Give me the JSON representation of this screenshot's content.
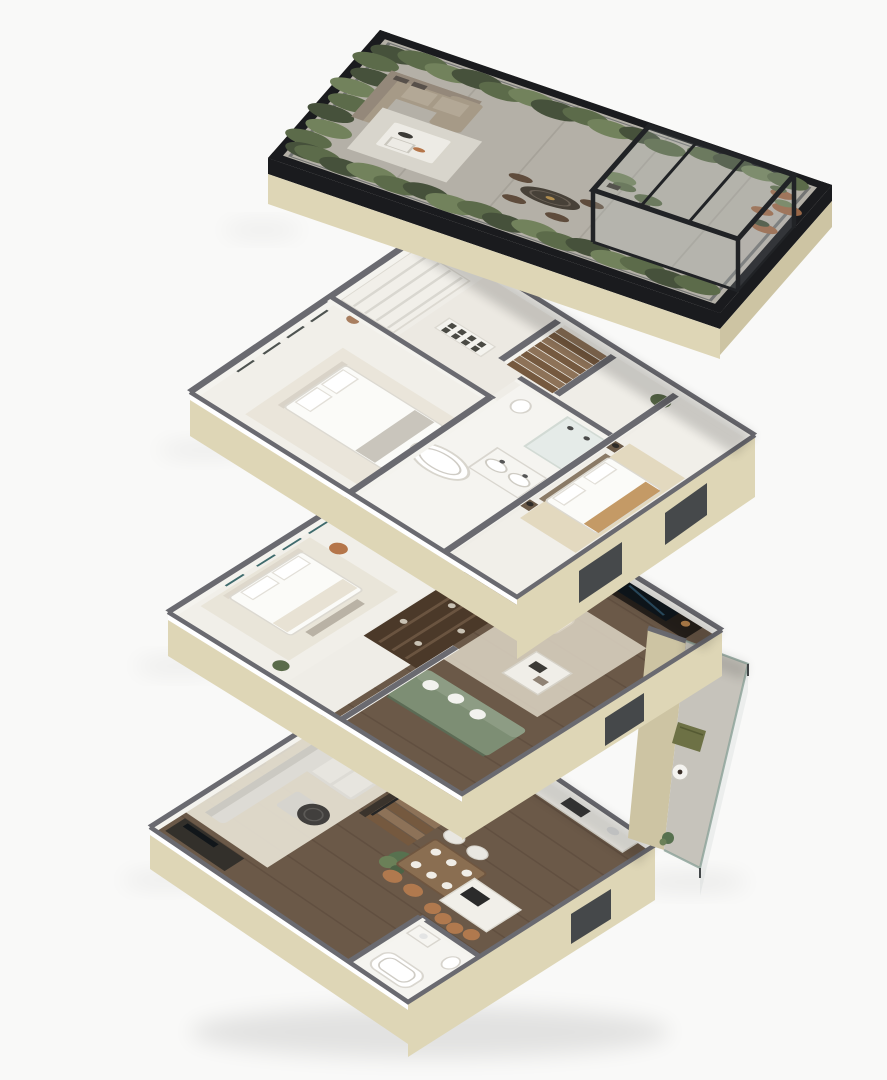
{
  "scene": {
    "type": "exploded-axonometric-floor-plan",
    "levels_count": 4,
    "floors": [
      {
        "id": "roof-terrace",
        "name": "roof terrace",
        "features": [
          "hedge planter border",
          "glass guardrail",
          "black parapet",
          "outdoor lounge sofa",
          "white coffee table deck",
          "round dining table with four chairs",
          "black glass pergola",
          "indoor plants",
          "terracotta pots"
        ]
      },
      {
        "id": "upper-bedroom-floor",
        "name": "upper bedroom floor",
        "features": [
          "master bedroom with bed",
          "wardrobe wall",
          "curtained window wall",
          "botanical art wall",
          "staircase",
          "bathroom with bathtub, double vanity, shower, toilet",
          "second bedroom with tan throw"
        ]
      },
      {
        "id": "middle-floor",
        "name": "middle floor",
        "features": [
          "bedroom with teal curtains",
          "copper pendant lamp",
          "walk-in closet shelving",
          "wc",
          "staircase",
          "tv lounge with media wall",
          "cream armchair with orange cushion",
          "white coffee table",
          "sage green daybed",
          "balcony with olive lounge chair and round table"
        ]
      },
      {
        "id": "ground-floor",
        "name": "ground floor",
        "features": [
          "living room sectional sofa",
          "round dark coffee table",
          "tv sideboard",
          "console table",
          "feature wood staircase",
          "planter",
          "dining table with white and rattan chairs",
          "kitchen island with bar stools",
          "kitchen cabinets",
          "bathroom with tub, vanity, toilet"
        ]
      }
    ],
    "palette": {
      "bg": "#f9f9f8",
      "slab-black": "#1a1b1e",
      "fascia-beige": "#ded6b6",
      "fascia-beige-shade": "#cdc4a3",
      "wall-cap-gray": "#6a6a70",
      "wall-white": "#f4f3ee",
      "floor-cream": "#efede7",
      "terrace-concrete": "#b4b0a7",
      "hedge-green-dark": "#46513b",
      "hedge-green": "#5c6b4a",
      "hedge-green-light": "#72825c",
      "pergola-frame": "#212326",
      "glass-tint": "#b9c2c4",
      "sofa-taupe": "#a69a87",
      "wood-floor": "#6b5948",
      "wood-floor-dark": "#59483a",
      "stair-wood": "#8d7258",
      "green-sofa": "#7d8e74",
      "olive-chair": "#6d7145",
      "teal-curtain": "#3f6b6d",
      "tan-accent": "#c49a66",
      "terracotta": "#9a6848",
      "rattan": "#b0794e",
      "orange-cushion": "#c57a3a",
      "rug-cream": "#e7e2d4"
    }
  }
}
